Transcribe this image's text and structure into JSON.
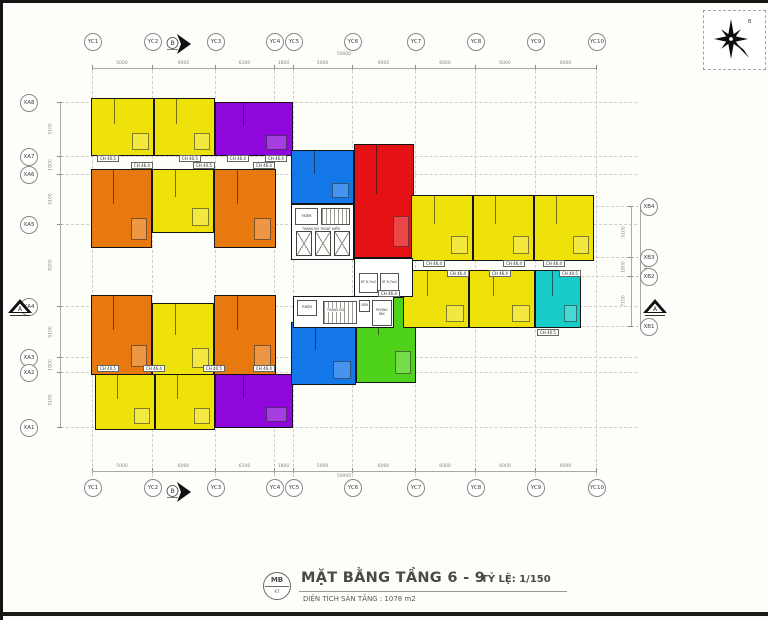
{
  "colors": {
    "yellow": "#EFE20B",
    "purple": "#8E07DC",
    "orange": "#E8790F",
    "blue": "#1377E8",
    "red": "#E51215",
    "cyan": "#17CCC9",
    "green": "#4FD31A",
    "wall": "#141414"
  },
  "grid": {
    "columns": [
      {
        "label": "YC1",
        "x": 89
      },
      {
        "label": "YC2",
        "x": 149
      },
      {
        "label": "YC3",
        "x": 212
      },
      {
        "label": "YC4",
        "x": 271
      },
      {
        "label": "YC5",
        "x": 290
      },
      {
        "label": "YC6",
        "x": 349
      },
      {
        "label": "YC7",
        "x": 412
      },
      {
        "label": "YC8",
        "x": 472
      },
      {
        "label": "YC9",
        "x": 532
      },
      {
        "label": "YC10",
        "x": 593
      }
    ],
    "rows_left": [
      {
        "label": "XA8",
        "y": 99
      },
      {
        "label": "XA7",
        "y": 153
      },
      {
        "label": "XA6",
        "y": 171
      },
      {
        "label": "XA5",
        "y": 221
      },
      {
        "label": "XA4",
        "y": 303
      },
      {
        "label": "XA3",
        "y": 354
      },
      {
        "label": "XA2",
        "y": 369
      },
      {
        "label": "XA1",
        "y": 424
      }
    ],
    "rows_right": [
      {
        "label": "XB4",
        "y": 203
      },
      {
        "label": "XB3",
        "y": 254
      },
      {
        "label": "XB2",
        "y": 273
      },
      {
        "label": "XB1",
        "y": 323
      }
    ],
    "dims_top": [
      "5000",
      "6000",
      "6100",
      "1800",
      "5000",
      "6000",
      "6000",
      "6000",
      "6000"
    ],
    "dims_bottom": [
      "5000",
      "6000",
      "6100",
      "1800",
      "5000",
      "6000",
      "6000",
      "6000",
      "6000"
    ],
    "total_width": "50000",
    "dims_left": [
      "5100",
      "1800",
      "5100",
      "8200",
      "5100",
      "1800",
      "5100"
    ],
    "dims_right": [
      "5100",
      "1800",
      "7100"
    ],
    "total_right": "14000"
  },
  "units": [
    {
      "id": "apt-topleft-1",
      "color": "yellow",
      "x": 88,
      "y": 95,
      "w": 63,
      "h": 58
    },
    {
      "id": "apt-topleft-2",
      "color": "yellow",
      "x": 151,
      "y": 95,
      "w": 61,
      "h": 58
    },
    {
      "id": "apt-top-purple",
      "color": "purple",
      "x": 212,
      "y": 99,
      "w": 78,
      "h": 54
    },
    {
      "id": "apt-mid-up-orange-l",
      "color": "orange",
      "x": 88,
      "y": 166,
      "w": 61,
      "h": 79
    },
    {
      "id": "apt-mid-up-yellow",
      "color": "yellow",
      "x": 149,
      "y": 166,
      "w": 62,
      "h": 64
    },
    {
      "id": "apt-mid-up-orange-r",
      "color": "orange",
      "x": 211,
      "y": 166,
      "w": 62,
      "h": 79
    },
    {
      "id": "apt-mid-low-orange-l",
      "color": "orange",
      "x": 88,
      "y": 292,
      "w": 61,
      "h": 80
    },
    {
      "id": "apt-mid-low-yellow",
      "color": "yellow",
      "x": 149,
      "y": 300,
      "w": 62,
      "h": 72
    },
    {
      "id": "apt-mid-low-orange-r",
      "color": "orange",
      "x": 211,
      "y": 292,
      "w": 62,
      "h": 80
    },
    {
      "id": "apt-botleft-1",
      "color": "yellow",
      "x": 92,
      "y": 371,
      "w": 60,
      "h": 56
    },
    {
      "id": "apt-botleft-2",
      "color": "yellow",
      "x": 152,
      "y": 371,
      "w": 60,
      "h": 56
    },
    {
      "id": "apt-bot-purple",
      "color": "purple",
      "x": 212,
      "y": 371,
      "w": 78,
      "h": 54
    },
    {
      "id": "apt-center-blue-up",
      "color": "blue",
      "x": 288,
      "y": 147,
      "w": 63,
      "h": 54
    },
    {
      "id": "apt-center-red",
      "color": "red",
      "x": 351,
      "y": 141,
      "w": 60,
      "h": 114
    },
    {
      "id": "apt-center-blue-low",
      "color": "blue",
      "x": 288,
      "y": 319,
      "w": 65,
      "h": 63
    },
    {
      "id": "apt-center-green",
      "color": "green",
      "x": 353,
      "y": 294,
      "w": 60,
      "h": 86
    },
    {
      "id": "apt-right-up-1",
      "color": "yellow",
      "x": 408,
      "y": 192,
      "w": 62,
      "h": 66
    },
    {
      "id": "apt-right-up-2",
      "color": "yellow",
      "x": 470,
      "y": 192,
      "w": 61,
      "h": 66
    },
    {
      "id": "apt-right-up-3",
      "color": "yellow",
      "x": 531,
      "y": 192,
      "w": 60,
      "h": 66
    },
    {
      "id": "apt-right-low-1",
      "color": "yellow",
      "x": 400,
      "y": 267,
      "w": 66,
      "h": 58
    },
    {
      "id": "apt-right-low-2",
      "color": "yellow",
      "x": 466,
      "y": 267,
      "w": 66,
      "h": 58
    },
    {
      "id": "apt-right-low-cyan",
      "color": "cyan",
      "x": 532,
      "y": 267,
      "w": 46,
      "h": 58
    }
  ],
  "chips": [
    {
      "x": 94,
      "y": 152,
      "label": "CH 40.5"
    },
    {
      "x": 176,
      "y": 152,
      "label": "CH 40.5"
    },
    {
      "x": 224,
      "y": 152,
      "label": "CH 46.4"
    },
    {
      "x": 262,
      "y": 152,
      "label": "CH 46.4"
    },
    {
      "x": 128,
      "y": 159,
      "label": "CH 46.4"
    },
    {
      "x": 190,
      "y": 159,
      "label": "CH 40.5"
    },
    {
      "x": 250,
      "y": 159,
      "label": "CH 46.4"
    },
    {
      "x": 420,
      "y": 257,
      "label": "CH 46.4"
    },
    {
      "x": 500,
      "y": 257,
      "label": "CH 46.4"
    },
    {
      "x": 540,
      "y": 257,
      "label": "CH 46.4"
    },
    {
      "x": 444,
      "y": 267,
      "label": "CH 46.4"
    },
    {
      "x": 486,
      "y": 267,
      "label": "CH 46.4"
    },
    {
      "x": 556,
      "y": 267,
      "label": "CH 40.5"
    },
    {
      "x": 94,
      "y": 362,
      "label": "CH 40.5"
    },
    {
      "x": 140,
      "y": 362,
      "label": "CH 46.4"
    },
    {
      "x": 200,
      "y": 362,
      "label": "CH 40.5"
    },
    {
      "x": 250,
      "y": 362,
      "label": "CH 46.4"
    },
    {
      "x": 375,
      "y": 287,
      "label": "CH 46.4"
    },
    {
      "x": 534,
      "y": 326,
      "label": "CH 40.5"
    }
  ],
  "cores": {
    "p_dem_upper": "P.ĐỆM",
    "thang_bo_thoat_hiem": "THANG BỘ THOÁT HIỂM",
    "kt1": "KT 6.7m2",
    "kt2": "KT 6.7m2",
    "p_dem_lower": "P.ĐỆM",
    "thang_bo": "THANG BỘ",
    "gen": "GEN",
    "phong_rac": "PHÒNG RÁC"
  },
  "markers": {
    "north_label": "B",
    "compass_label": "B",
    "section_left": "A",
    "section_right": "A"
  },
  "titleblock": {
    "stamp_top": "MB",
    "stamp_bottom": "KT",
    "title": "MẶT BẰNG TẦNG 6 - 9",
    "scale": "TỶ LỆ: 1/150",
    "area": "DIỆN TÍCH SÀN TẦNG : 1078 m2"
  }
}
